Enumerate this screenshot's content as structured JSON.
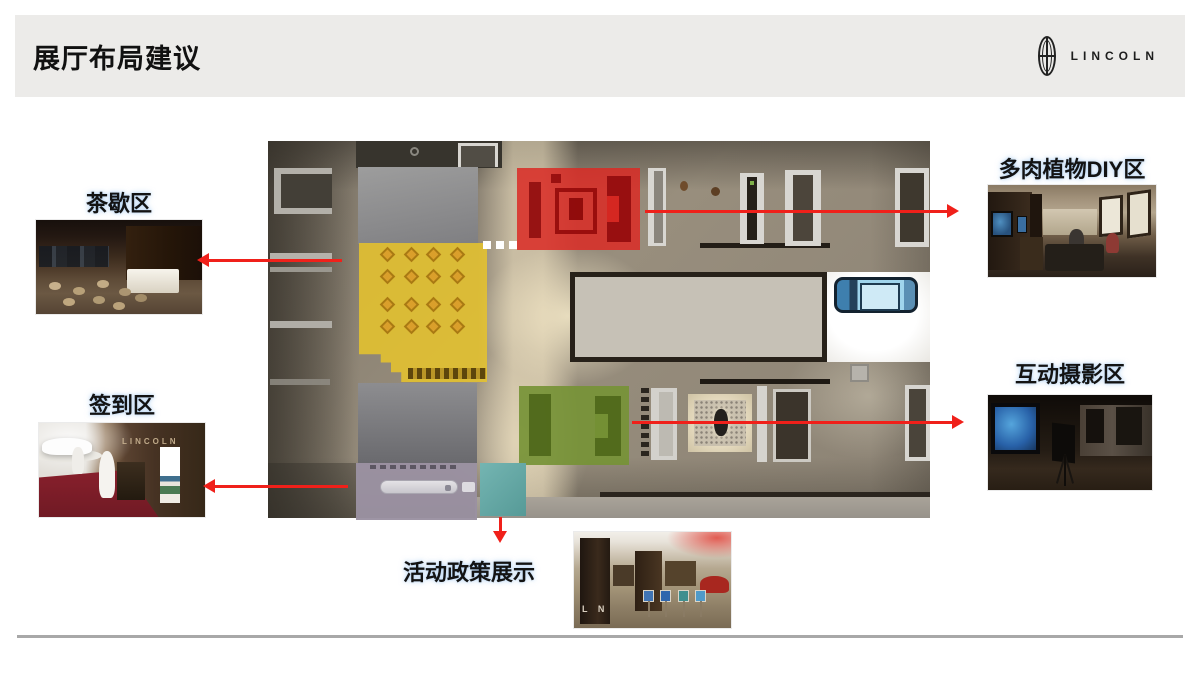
{
  "slide": {
    "header": {
      "title": "展厅布局建议",
      "brand": {
        "name": "LINCOLN",
        "icon": "lincoln-badge-icon"
      }
    },
    "callouts": {
      "tea_break": {
        "label": "茶歇区"
      },
      "sign_in": {
        "label": "签到区"
      },
      "succulent_diy": {
        "label": "多肉植物DIY区"
      },
      "interactive_photo": {
        "label": "互动摄影区"
      },
      "policy_display": {
        "label": "活动政策展示"
      }
    },
    "floorplan": {
      "zones": [
        {
          "id": "succulent-diy-zone",
          "color": "#db2a24",
          "links_to": "多肉植物DIY区"
        },
        {
          "id": "tea-break-zone",
          "color": "#e8c42c",
          "links_to": "茶歇区"
        },
        {
          "id": "interactive-photo-zone",
          "color": "#769236",
          "links_to": "互动摄影区"
        },
        {
          "id": "policy-display-zone",
          "color": "#64a9a6",
          "links_to": "活动政策展示"
        },
        {
          "id": "sign-in-zone",
          "color": "#9a91a1",
          "links_to": "签到区"
        }
      ]
    },
    "photo_overlays": {
      "policy_pillar_text": "L N",
      "sign_in_wall_text": "LINCOLN"
    },
    "colors": {
      "arrow": "#f0201a",
      "banner_bg": "#ecebe9",
      "divider": "#a8a8a8"
    }
  }
}
